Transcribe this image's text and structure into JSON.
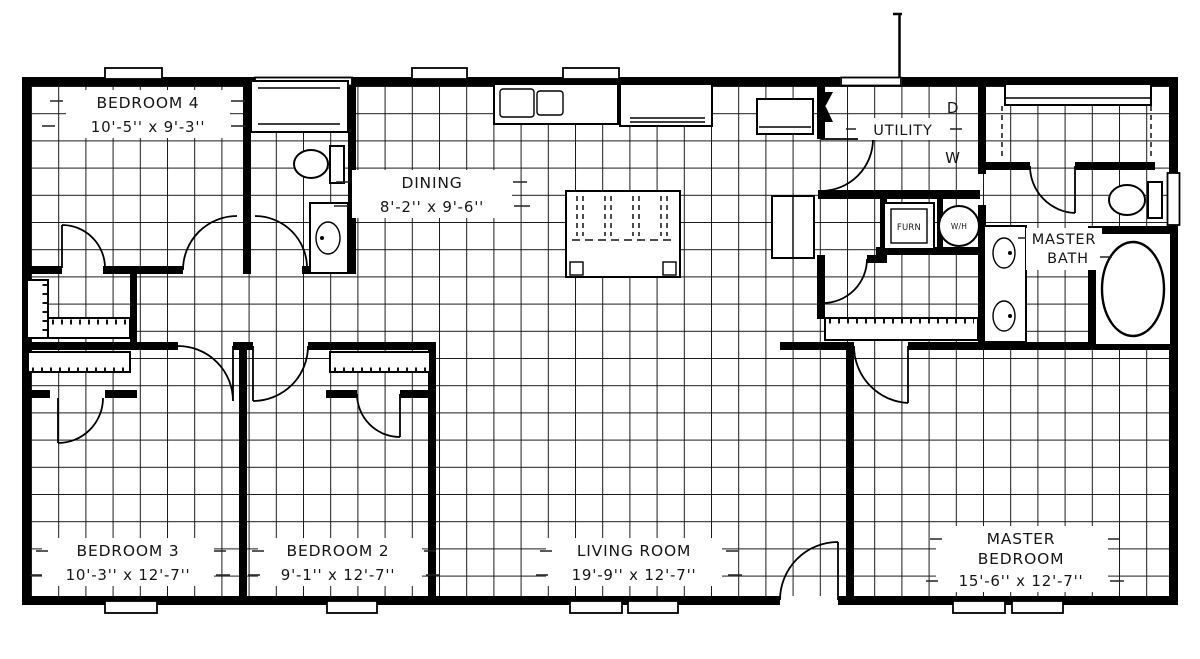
{
  "colors": {
    "wall": "#000000",
    "grid_line": "#1a1a1a",
    "paper": "#ffffff",
    "ink": "#161616"
  },
  "rooms": {
    "bedroom4": {
      "name": "BEDROOM 4",
      "dims": "10'-5'' x 9'-3''"
    },
    "dining": {
      "name": "DINING",
      "dims": "8'-2'' x 9'-6''"
    },
    "utility": {
      "name": "UTILITY"
    },
    "master_bath": {
      "line1": "MASTER",
      "line2": "BATH"
    },
    "bedroom3": {
      "name": "BEDROOM 3",
      "dims": "10'-3'' x 12'-7''"
    },
    "bedroom2": {
      "name": "BEDROOM 2",
      "dims": "9'-1'' x 12'-7''"
    },
    "living_room": {
      "name": "LIVING ROOM",
      "dims": "19'-9'' x 12'-7''"
    },
    "master_bedroom": {
      "line1": "MASTER",
      "line2": "BEDROOM",
      "dims": "15'-6'' x 12'-7''"
    }
  },
  "appliances": {
    "dryer": "D",
    "washer": "W",
    "furnace": "FURN",
    "water_heater": "W/H"
  }
}
